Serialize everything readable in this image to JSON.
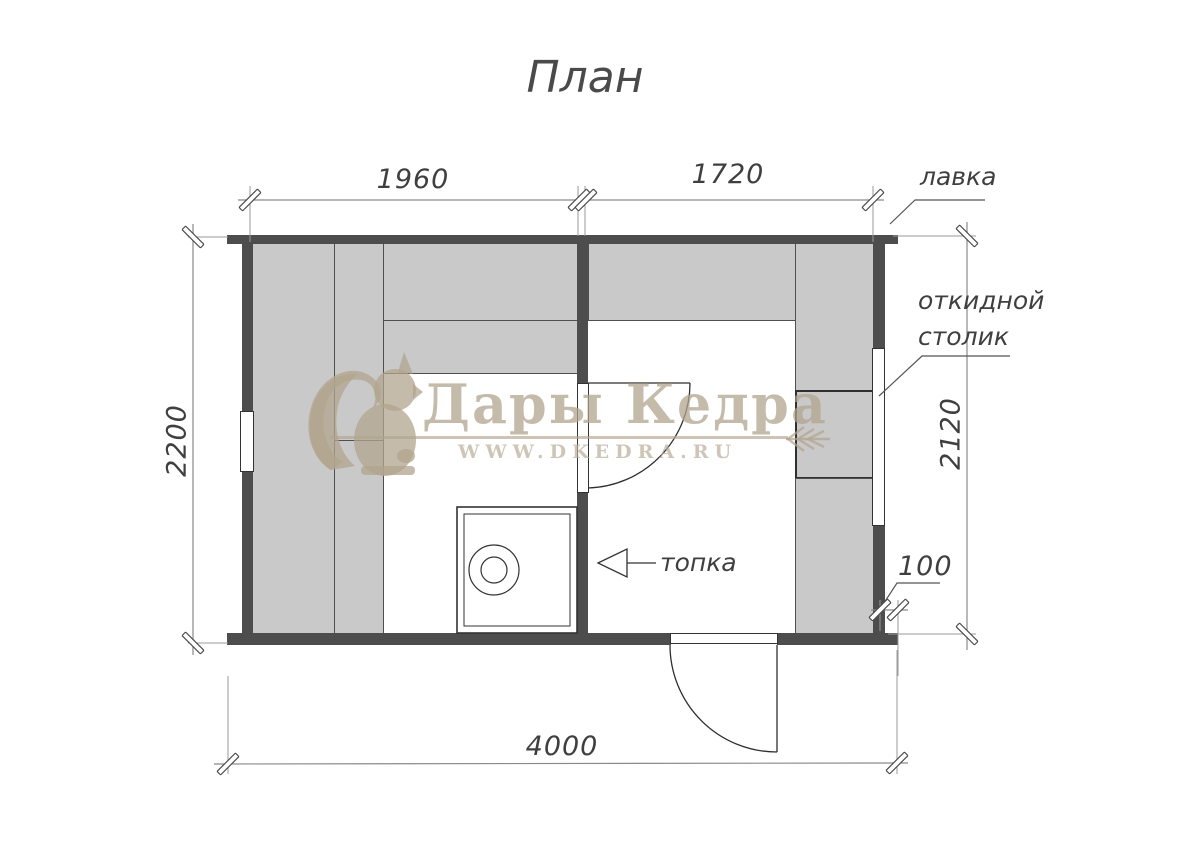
{
  "title": "План",
  "watermark": {
    "brand": "Дары Кедра",
    "website": "WWW.DKEDRA.RU"
  },
  "dimensions": {
    "steam_room_width": "1960",
    "rest_room_width": "1720",
    "left_outer_depth": "2200",
    "right_inner_depth": "2120",
    "total_length": "4000",
    "wall_ledge": "100"
  },
  "labels": {
    "bench": "лавка",
    "folding_table_line1": "откидной",
    "folding_table_line2": "столик",
    "firebox": "топка"
  },
  "colors": {
    "wall": "#4d4d4d",
    "bench_fill": "#c9c9c9",
    "outline": "#333333",
    "dimension_line": "#8a8a8a",
    "text": "#3f3f3f",
    "watermark": "#c5b9a7",
    "background": "#ffffff"
  }
}
